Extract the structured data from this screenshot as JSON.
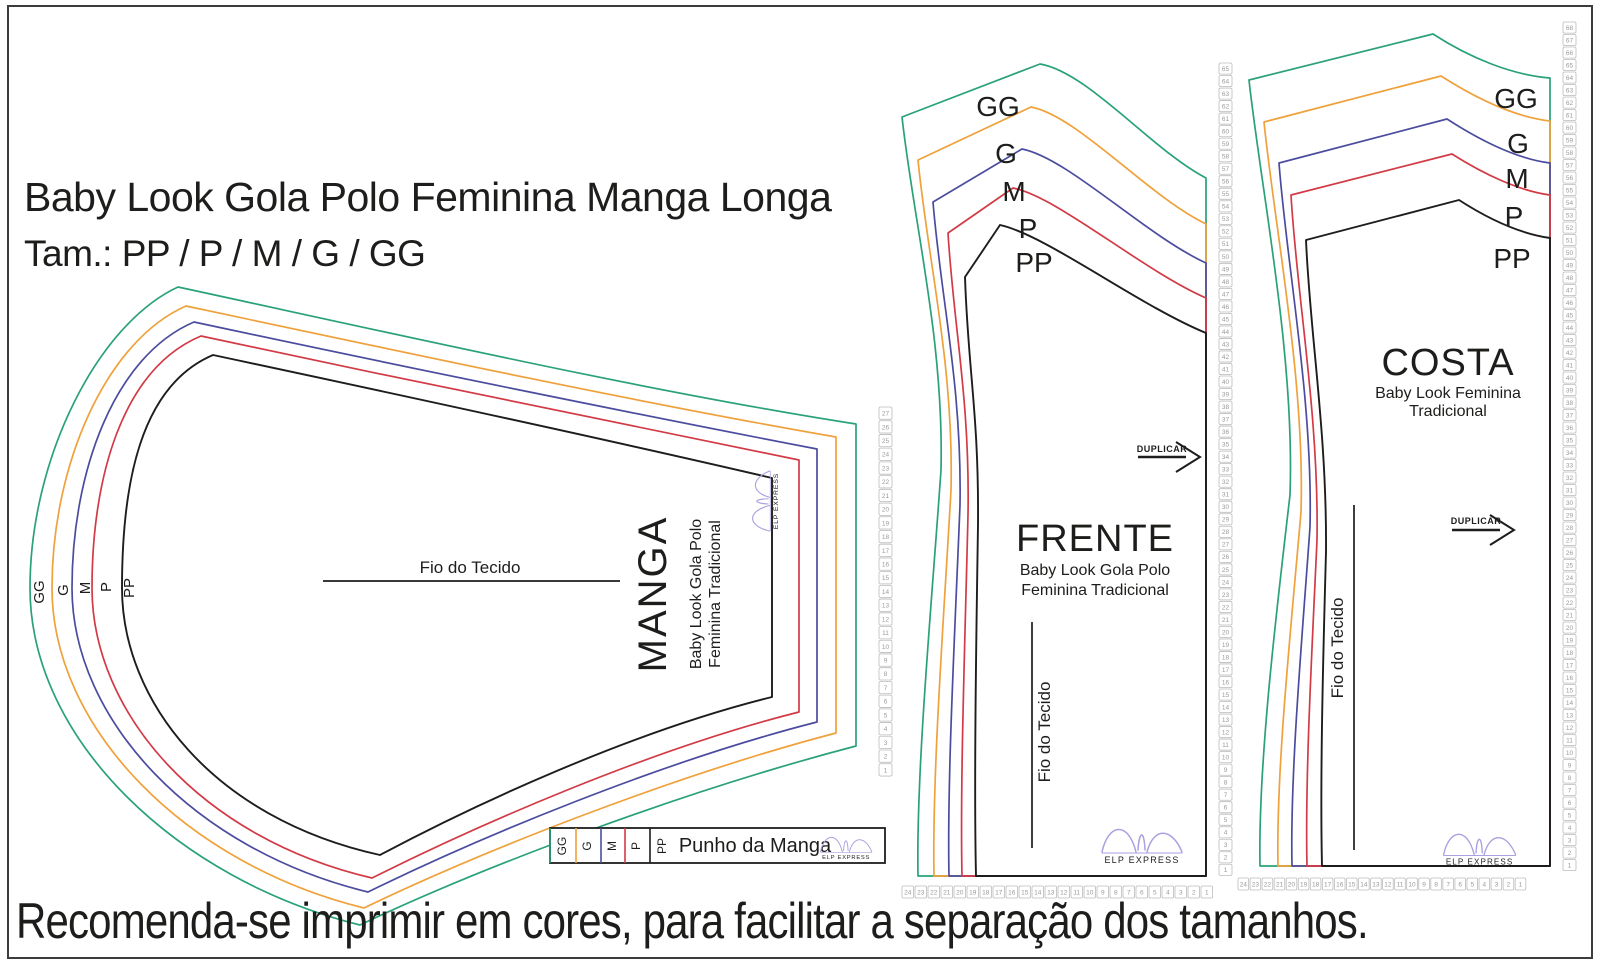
{
  "header": {
    "title": "Baby Look Gola Polo Feminina Manga Longa",
    "subtitle": "Tam.: PP / P / M / G / GG"
  },
  "footer": {
    "note": "Recomenda-se imprimir em cores, para facilitar a separação dos tamanhos."
  },
  "sizes": [
    {
      "code": "GG",
      "color": "#2aa277"
    },
    {
      "code": "G",
      "color": "#efa13b"
    },
    {
      "code": "M",
      "color": "#4c4c9f"
    },
    {
      "code": "P",
      "color": "#d23a45"
    },
    {
      "code": "PP",
      "color": "#1d1d1b"
    }
  ],
  "pieces": {
    "manga": {
      "name": "MANGA",
      "desc1": "Baby Look Gola Polo",
      "desc2": "Feminina Tradicional",
      "grain": "Fio do Tecido"
    },
    "frente": {
      "name": "FRENTE",
      "desc1": "Baby Look Gola Polo",
      "desc2": "Feminina Tradicional",
      "grain": "Fio do Tecido",
      "duplicate": "DUPLICAR"
    },
    "costa": {
      "name": "COSTA",
      "desc1": "Baby Look Feminina",
      "desc2": "Tradicional",
      "grain": "Fio do Tecido",
      "duplicate": "DUPLICAR"
    },
    "punho": {
      "name": "Punho da Manga"
    }
  },
  "logo": {
    "text": "ELP EXPRESS",
    "color": "#a9a1e0"
  },
  "rulers": [
    {
      "from": 27,
      "to": 1
    },
    {
      "from": 65,
      "to": 1
    },
    {
      "from": 68,
      "to": 1
    },
    {
      "from": 24,
      "to": 1
    },
    {
      "from": 24,
      "to": 1
    }
  ]
}
